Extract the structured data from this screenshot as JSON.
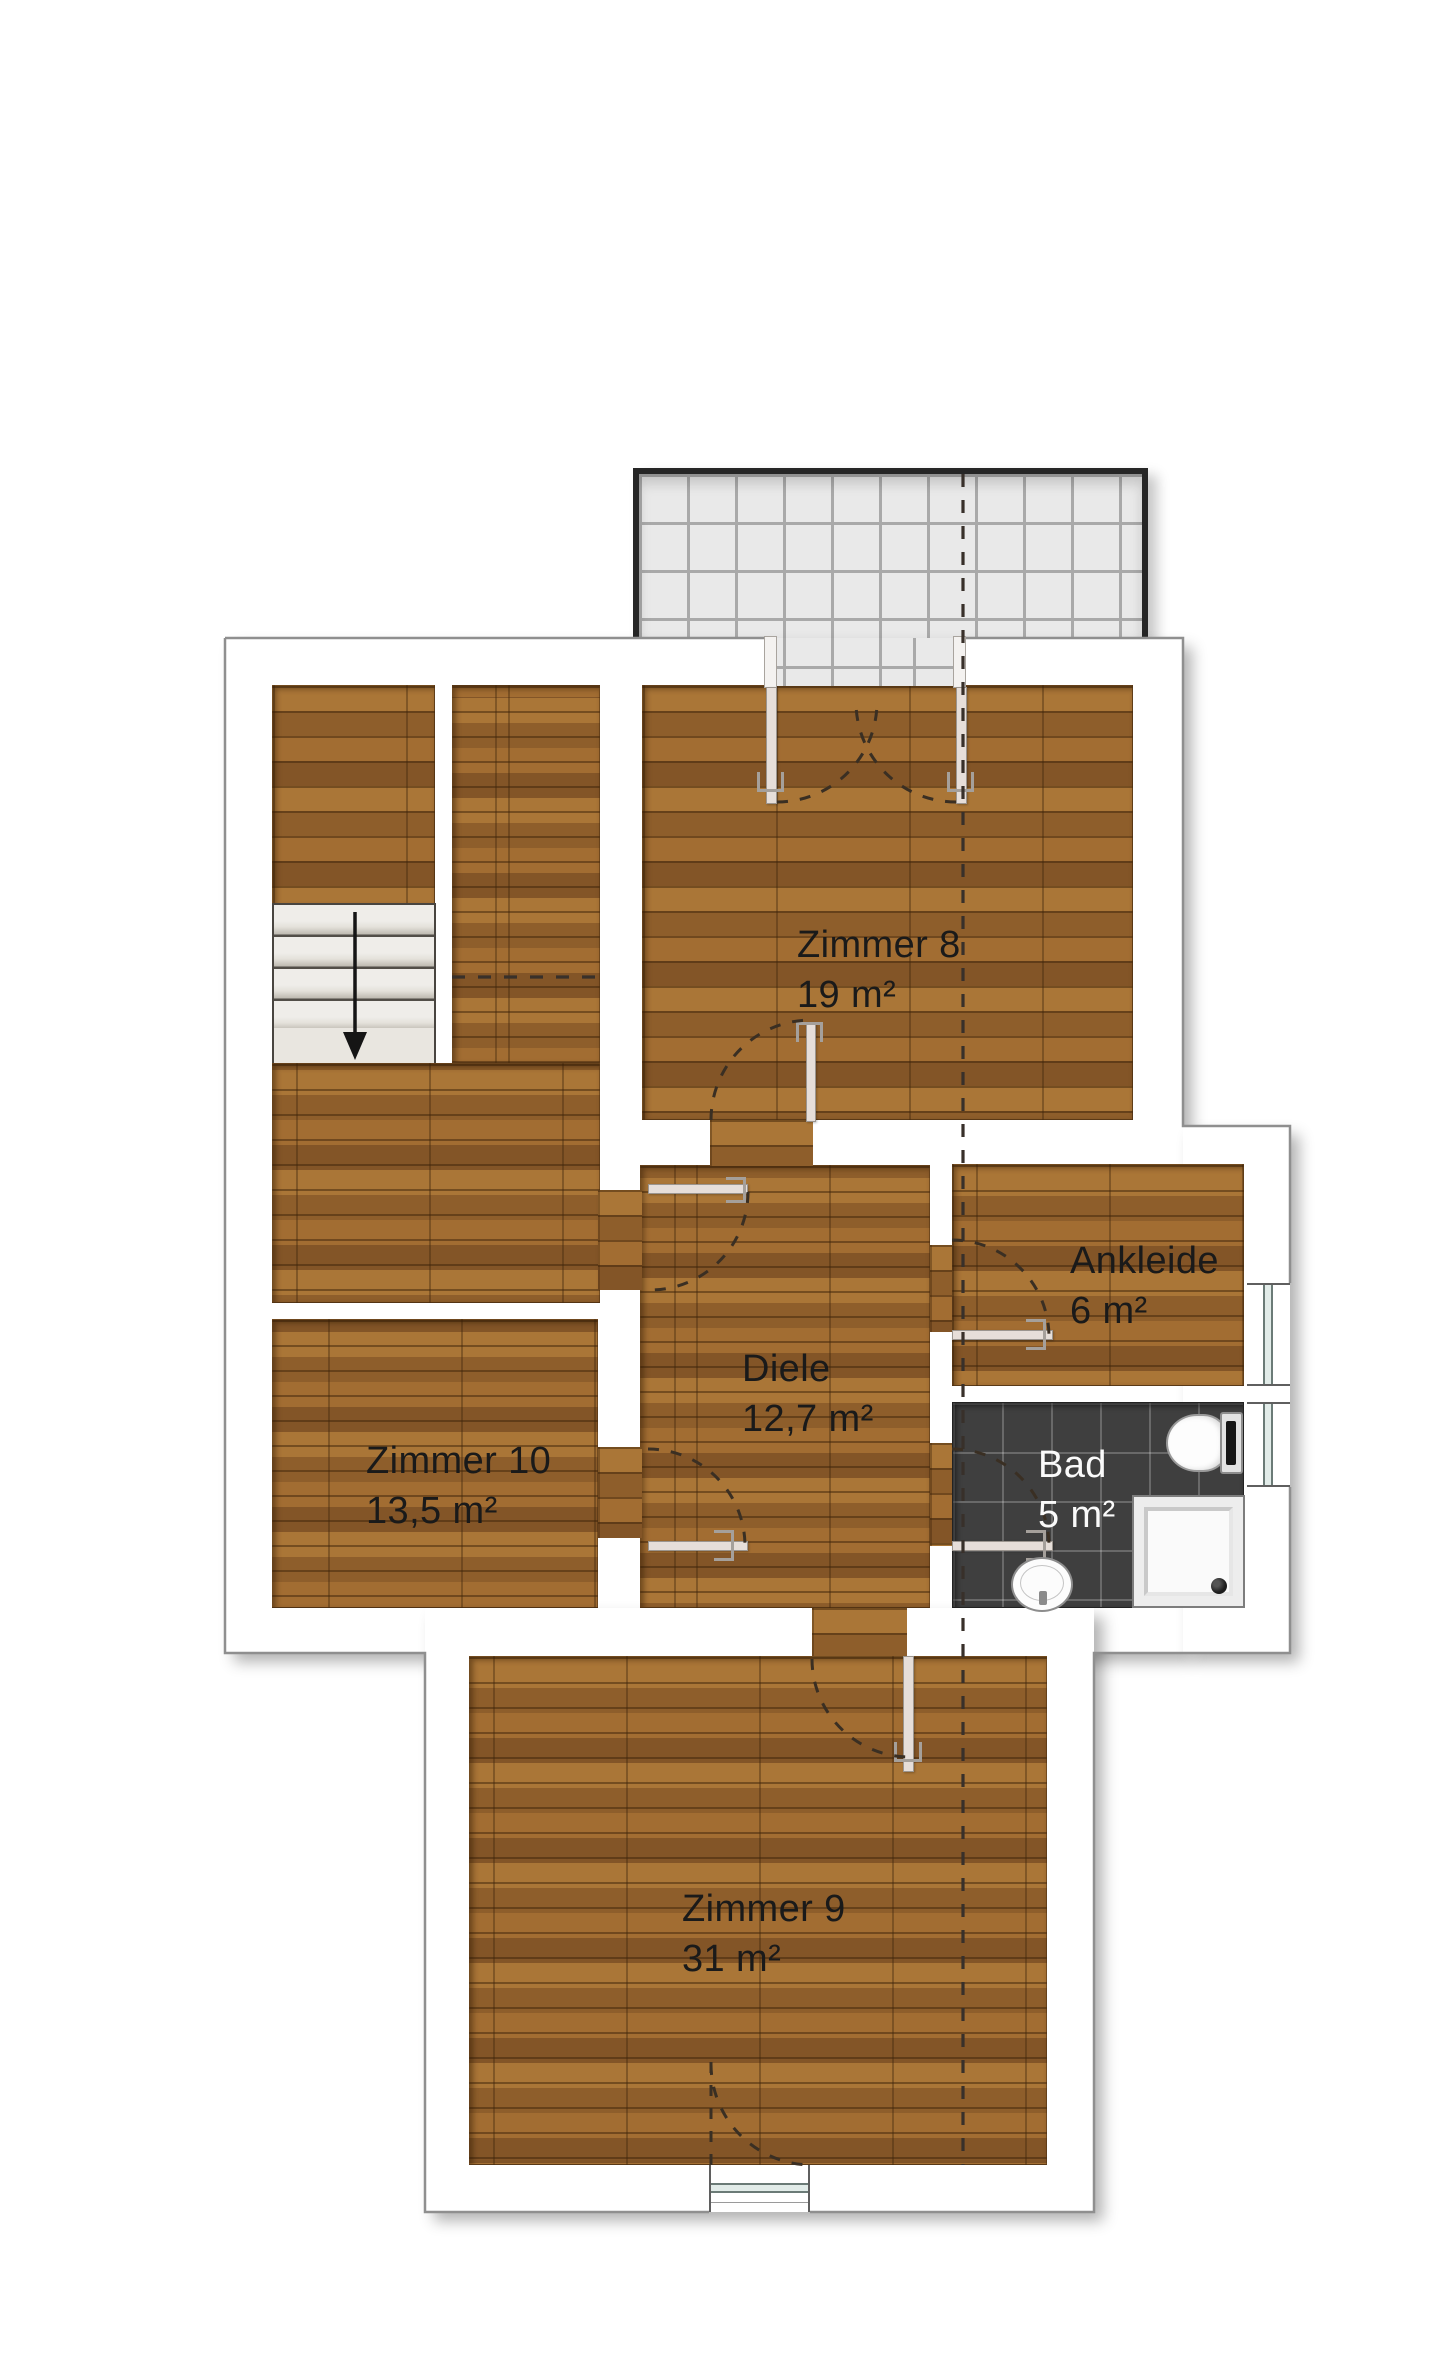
{
  "plan": {
    "kind": "floor-plan",
    "rooms": [
      {
        "id": "zimmer8",
        "name": "Zimmer 8",
        "area": "19 m²"
      },
      {
        "id": "ankleide",
        "name": "Ankleide",
        "area": "6 m²"
      },
      {
        "id": "diele",
        "name": "Diele",
        "area": "12,7 m²"
      },
      {
        "id": "zimmer10",
        "name": "Zimmer 10",
        "area": "13,5 m²"
      },
      {
        "id": "bad",
        "name": "Bad",
        "area": "5 m²"
      },
      {
        "id": "zimmer9",
        "name": "Zimmer 9",
        "area": "31 m²"
      }
    ],
    "fixtures": [
      "balcony-tiled-terrace",
      "staircase-down-arrow",
      "toilet",
      "shower-tray",
      "washbasin",
      "window-ankleide",
      "window-bad",
      "window-zimmer9",
      "balcony-double-door",
      "roof-slope-dashed-line",
      "door-swing-arcs"
    ],
    "colors": {
      "wood_floor": "#9a6831",
      "bath_tile": "#3f3f3f",
      "balcony_tile": "#e9e9e9",
      "balcony_border": "#262626",
      "wall": "#ffffff",
      "outline": "#8f8f8f",
      "door_leaf": "#e6ded9",
      "glass": "#e2ece9",
      "stairs": "#e9e6e0",
      "label_dark": "#1a1a1a",
      "label_light": "#fafafa"
    }
  }
}
